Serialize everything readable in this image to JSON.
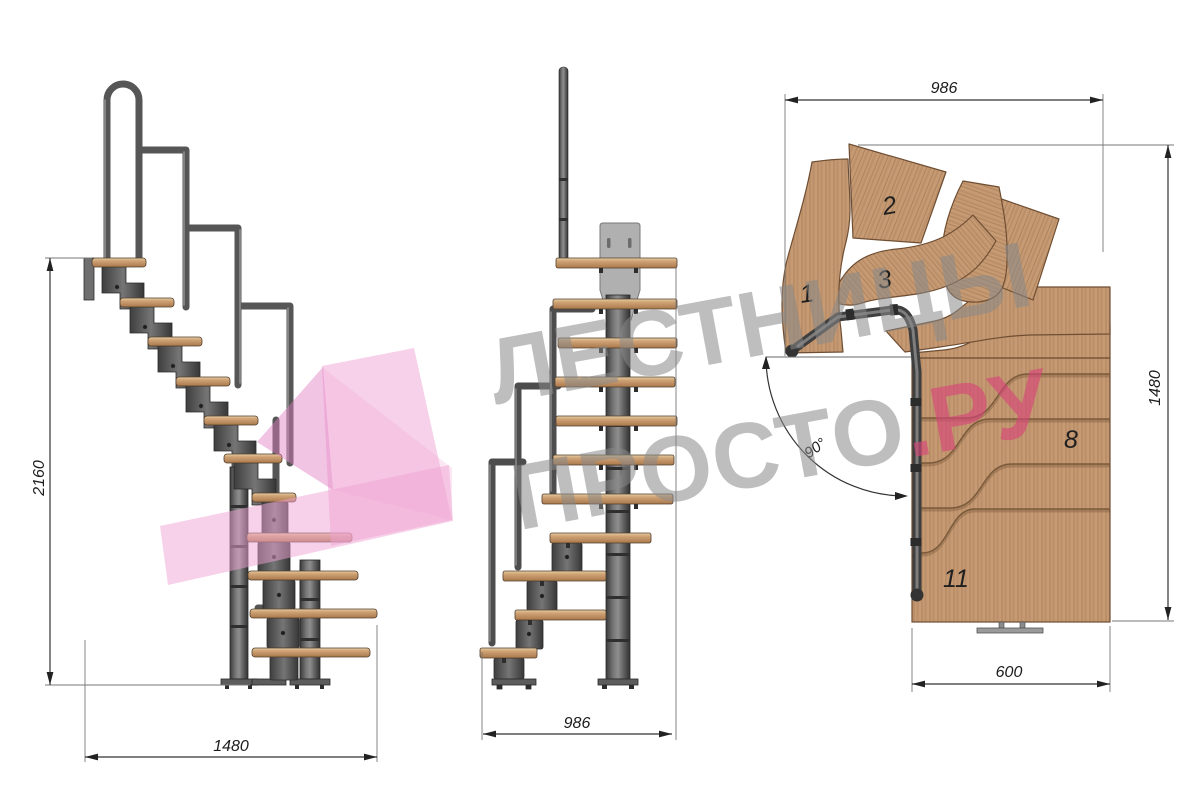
{
  "colors": {
    "wm_gray": "rgba(136,136,136,0.55)",
    "wm_accent": "rgba(216,67,121,0.62)",
    "arrow_pink": "#f0a3d4",
    "wood": "#c69a72",
    "metal": "#5a5a5a",
    "dim_line": "#333333"
  },
  "watermark": {
    "line1": "ЛЕСТНИЦЫ",
    "line2": "ПРОСТО",
    "accent": ".РУ"
  },
  "side_view": {
    "height": "2160",
    "width": "1480"
  },
  "front_view": {
    "width": "986"
  },
  "plan_view": {
    "top": "986",
    "right": "1480",
    "bottom": "600",
    "angle": "90°",
    "labels": [
      "1",
      "2",
      "3",
      "8",
      "11"
    ]
  }
}
